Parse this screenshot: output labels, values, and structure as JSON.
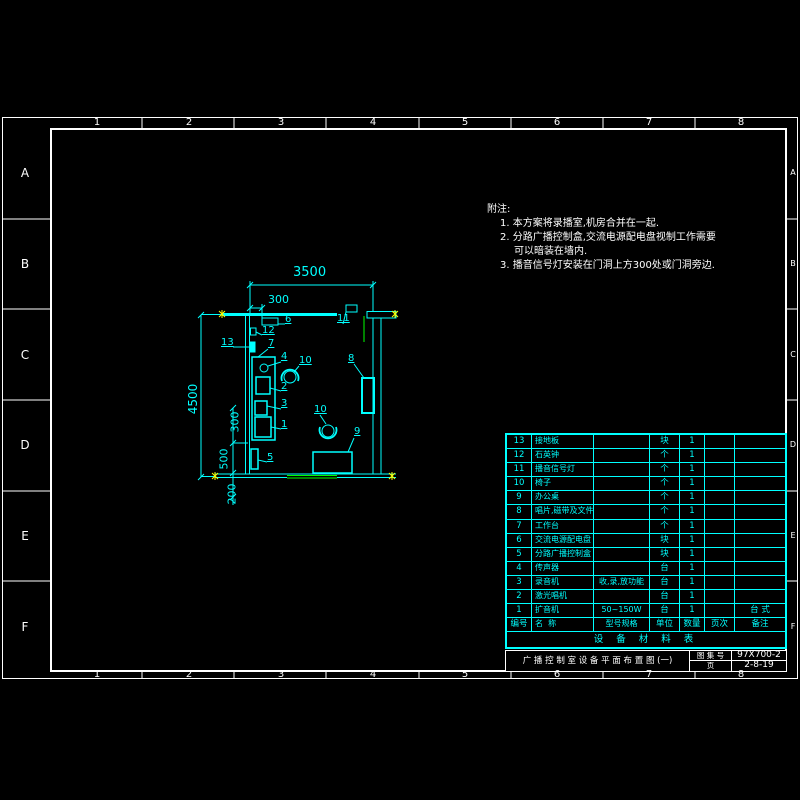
{
  "frame": {
    "column_labels": [
      "1",
      "2",
      "3",
      "4",
      "5",
      "6",
      "7",
      "8"
    ],
    "row_labels": [
      "A",
      "B",
      "C",
      "D",
      "E",
      "F"
    ]
  },
  "notes": {
    "title": "附注:",
    "lines": [
      "1. 本方案将录播室,机房合并在一起.",
      "2. 分路广播控制盒,交流电源配电盘视制工作需要",
      "可以暗装在墙内.",
      "3. 播音信号灯安装在门洞上方300处或门洞旁边."
    ]
  },
  "plan": {
    "dimensions": {
      "top_total": "3500",
      "top_offset": "300",
      "left_total": "4500",
      "left_300": "300",
      "left_500": "500",
      "left_200": "200"
    },
    "labels": {
      "n1": "1",
      "n2": "2",
      "n3": "3",
      "n4": "4",
      "n5": "5",
      "n6": "6",
      "n7": "7",
      "n8": "8",
      "n9": "9",
      "n10a": "10",
      "n10b": "10",
      "n11": "11",
      "n12": "12",
      "n13": "13"
    }
  },
  "equipment_table": {
    "title": "设 备 材 料 表",
    "headers": {
      "no": "编号",
      "name": "名  称",
      "spec": "型号规格",
      "unit": "单位",
      "qty": "数量",
      "page": "页次",
      "remark": "备注"
    },
    "rows": [
      {
        "no": "13",
        "name": "接地板",
        "spec": "",
        "unit": "块",
        "qty": "1",
        "page": "",
        "remark": ""
      },
      {
        "no": "12",
        "name": "石英钟",
        "spec": "",
        "unit": "个",
        "qty": "1",
        "page": "",
        "remark": ""
      },
      {
        "no": "11",
        "name": "播音信号灯",
        "spec": "",
        "unit": "个",
        "qty": "1",
        "page": "",
        "remark": ""
      },
      {
        "no": "10",
        "name": "椅子",
        "spec": "",
        "unit": "个",
        "qty": "1",
        "page": "",
        "remark": ""
      },
      {
        "no": "9",
        "name": "办公桌",
        "spec": "",
        "unit": "个",
        "qty": "1",
        "page": "",
        "remark": ""
      },
      {
        "no": "8",
        "name": "唱片,磁带及文件柜",
        "spec": "",
        "unit": "个",
        "qty": "1",
        "page": "",
        "remark": ""
      },
      {
        "no": "7",
        "name": "工作台",
        "spec": "",
        "unit": "个",
        "qty": "1",
        "page": "",
        "remark": ""
      },
      {
        "no": "6",
        "name": "交流电源配电盘",
        "spec": "",
        "unit": "块",
        "qty": "1",
        "page": "",
        "remark": ""
      },
      {
        "no": "5",
        "name": "分路广播控制盒",
        "spec": "",
        "unit": "块",
        "qty": "1",
        "page": "",
        "remark": ""
      },
      {
        "no": "4",
        "name": "传声器",
        "spec": "",
        "unit": "台",
        "qty": "1",
        "page": "",
        "remark": ""
      },
      {
        "no": "3",
        "name": "录音机",
        "spec": "收,录,放功能",
        "unit": "台",
        "qty": "1",
        "page": "",
        "remark": ""
      },
      {
        "no": "2",
        "name": "激光唱机",
        "spec": "",
        "unit": "台",
        "qty": "1",
        "page": "",
        "remark": ""
      },
      {
        "no": "1",
        "name": "扩音机",
        "spec": "50~150W",
        "unit": "台",
        "qty": "1",
        "page": "",
        "remark": "台 式"
      }
    ]
  },
  "title_block": {
    "drawing_title": "广 播 控 制 室 设 备 平 面 布 置 图 (一)",
    "atlas_label": "图 集 号",
    "atlas_no": "97X700-2",
    "page_label": "页",
    "page_no": "2-8-19"
  },
  "colors": {
    "line": "#00ffff",
    "frame": "#ffffff",
    "door": "#00ff00",
    "marker": "#ffff00",
    "background": "#000000"
  }
}
